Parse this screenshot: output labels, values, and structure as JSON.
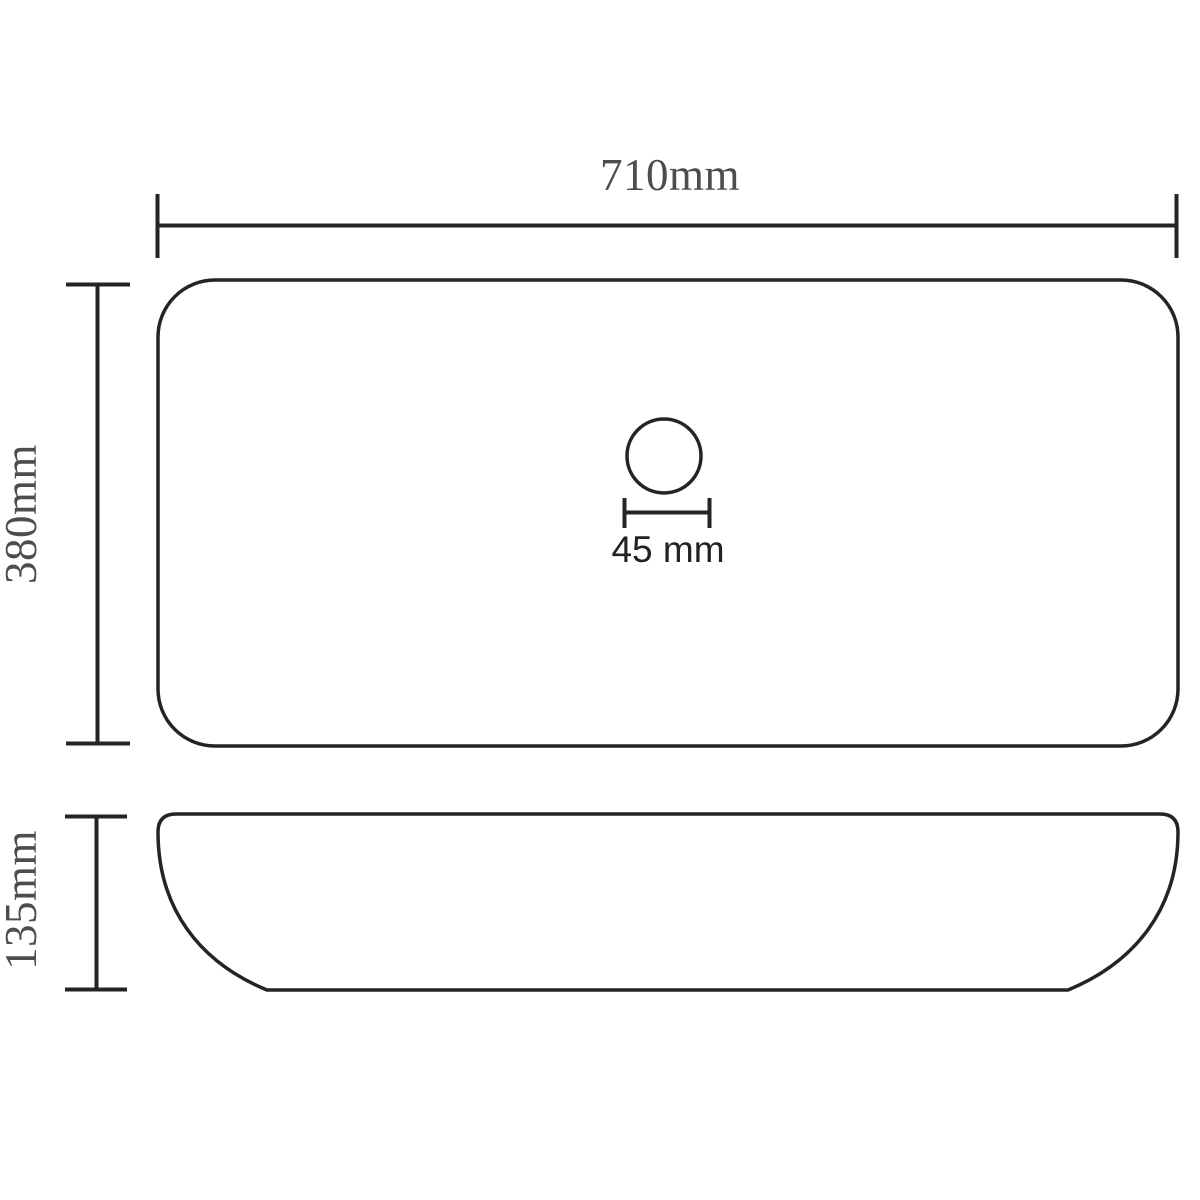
{
  "diagram": {
    "title": "washbasin-dimension-drawing",
    "background_color": "#ffffff",
    "line_color": "#272325",
    "label_color": "#4d4d4d",
    "drain_label_color": "#222222",
    "top_view": {
      "width_label": "710mm",
      "depth_label": "380mm",
      "drain_label": "45 mm"
    },
    "side_view": {
      "height_label": "135mm"
    }
  }
}
